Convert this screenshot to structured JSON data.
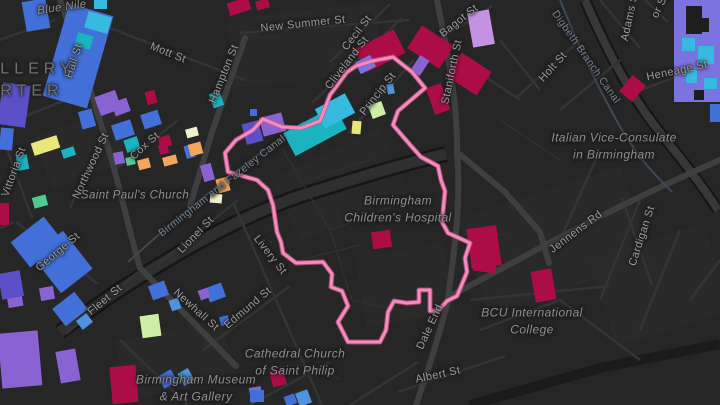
{
  "map": {
    "palette": {
      "background": "#262626",
      "road_minor": "#343434",
      "road_major": "#3f3f3f",
      "road_band_casing": "#161616",
      "road_band_fill": "#2f2f2f",
      "rail_band": "#1b1b1b",
      "canal_line": "#3d4a55",
      "label": "#9a9a9a",
      "boundary_core": "#f48cbe",
      "boundary_casing": "#c9568d",
      "buildings": {
        "crimson": "#ad0d47",
        "plum": "#c492e2",
        "purple": "#8a63d2",
        "violet": "#5b50c8",
        "blue": "#4270d8",
        "lightblue": "#4f93dc",
        "cyan": "#37b9e0",
        "teal": "#1bb3c0",
        "green": "#52c98f",
        "mint": "#cdeea6",
        "cream": "#f2f0c8",
        "yellow": "#e9e77c",
        "orange": "#f2a55c",
        "periwinkle": "#7b74e0",
        "dark": "#1e1e1e"
      }
    },
    "district_label": {
      "lines": [
        "LLERY",
        "RTER"
      ],
      "x": 2,
      "y": 80
    },
    "street_labels": [
      {
        "text": "New Summer St",
        "x": 303,
        "y": 24,
        "rot": -6
      },
      {
        "text": "Cecil St",
        "x": 357,
        "y": 33,
        "rot": -52
      },
      {
        "text": "Cliveland St",
        "x": 347,
        "y": 63,
        "rot": -52
      },
      {
        "text": "Princip St",
        "x": 378,
        "y": 94,
        "rot": -52
      },
      {
        "text": "Mott St",
        "x": 168,
        "y": 53,
        "rot": 22
      },
      {
        "text": "Hall St",
        "x": 74,
        "y": 61,
        "rot": -72
      },
      {
        "text": "Hampton St",
        "x": 224,
        "y": 74,
        "rot": -68
      },
      {
        "text": "Bagot St",
        "x": 459,
        "y": 21,
        "rot": -38
      },
      {
        "text": "Staniforth St",
        "x": 452,
        "y": 72,
        "rot": -78
      },
      {
        "text": "Holt St",
        "x": 553,
        "y": 67,
        "rot": -48
      },
      {
        "text": "Adams St",
        "x": 630,
        "y": 16,
        "rot": -78
      },
      {
        "text": "or St",
        "x": 660,
        "y": 6,
        "rot": -65
      },
      {
        "text": "Heneage St",
        "x": 677,
        "y": 71,
        "rot": -12
      },
      {
        "text": "Vittoria St",
        "x": 14,
        "y": 172,
        "rot": -70
      },
      {
        "text": "Northwood St",
        "x": 91,
        "y": 166,
        "rot": -65
      },
      {
        "text": "Cox St",
        "x": 145,
        "y": 146,
        "rot": -42
      },
      {
        "text": "George St",
        "x": 58,
        "y": 252,
        "rot": -40
      },
      {
        "text": "Lionel St",
        "x": 196,
        "y": 235,
        "rot": -46
      },
      {
        "text": "Livery St",
        "x": 270,
        "y": 255,
        "rot": 52
      },
      {
        "text": "Newhall St",
        "x": 196,
        "y": 310,
        "rot": 42
      },
      {
        "text": "Edmund St",
        "x": 248,
        "y": 308,
        "rot": -40
      },
      {
        "text": "Fleet St",
        "x": 105,
        "y": 300,
        "rot": -40
      },
      {
        "text": "Jennens Rd",
        "x": 576,
        "y": 232,
        "rot": -37
      },
      {
        "text": "Cardigan St",
        "x": 642,
        "y": 236,
        "rot": -72
      },
      {
        "text": "Dale End",
        "x": 430,
        "y": 327,
        "rot": -65
      },
      {
        "text": "Albert St",
        "x": 438,
        "y": 375,
        "rot": -12
      }
    ],
    "canal_labels": [
      {
        "text": "Digbeth Branch Canal",
        "x": 586,
        "y": 57,
        "rot": 55
      },
      {
        "text": "Birmingham and Fazeley Canal",
        "x": 222,
        "y": 186,
        "rot": -38
      }
    ],
    "poi_labels": [
      {
        "lines": [
          "Blue Nile"
        ],
        "x": 62,
        "y": 8,
        "rot": -8
      },
      {
        "lines": [
          "Saint Paul's Church"
        ],
        "x": 135,
        "y": 196,
        "rot": 0
      },
      {
        "lines": [
          "Birmingham",
          "Children's Hospital"
        ],
        "x": 398,
        "y": 210,
        "rot": 0,
        "fs": 12
      },
      {
        "lines": [
          "Italian Vice-Consulate",
          "in Birmingham"
        ],
        "x": 614,
        "y": 147,
        "rot": 0,
        "fs": 12
      },
      {
        "lines": [
          "Cathedral Church",
          "of Saint Philip"
        ],
        "x": 295,
        "y": 363,
        "rot": 0,
        "fs": 12
      },
      {
        "lines": [
          "Birmingham Museum",
          "& Art Gallery"
        ],
        "x": 196,
        "y": 389,
        "rot": 0,
        "fs": 12
      },
      {
        "lines": [
          "BCU International",
          "College"
        ],
        "x": 532,
        "y": 322,
        "rot": 0,
        "fs": 12
      }
    ],
    "boundary": {
      "points": "253,130 263,119 282,127 301,128 320,121 330,95 347,72 356,66 372,61 393,57 412,72 425,88 398,111 393,125 412,147 421,157 438,166 441,180 445,191 442,222 448,233 470,243 465,258 467,272 457,296 447,301 438,311 430,311 430,290 419,290 419,302 407,303 394,301 388,312 386,330 380,342 348,342 338,322 348,306 342,291 331,287 332,274 323,262 296,263 283,253 281,242 277,232 273,205 268,190 257,180 228,172 225,153 236,140"
    },
    "buildings": [
      [
        55,
        8,
        46,
        96,
        16,
        "blue"
      ],
      [
        86,
        14,
        24,
        17,
        16,
        "cyan"
      ],
      [
        76,
        34,
        16,
        14,
        16,
        "teal"
      ],
      [
        24,
        0,
        24,
        30,
        -10,
        "blue"
      ],
      [
        94,
        0,
        13,
        9,
        0,
        "cyan"
      ],
      [
        0,
        84,
        28,
        42,
        8,
        "violet"
      ],
      [
        0,
        128,
        13,
        22,
        5,
        "blue"
      ],
      [
        32,
        139,
        27,
        13,
        -18,
        "yellow"
      ],
      [
        62,
        148,
        13,
        9,
        -18,
        "teal"
      ],
      [
        17,
        155,
        11,
        15,
        -10,
        "teal"
      ],
      [
        33,
        196,
        14,
        11,
        -15,
        "green"
      ],
      [
        0,
        203,
        9,
        22,
        0,
        "crimson"
      ],
      [
        114,
        152,
        10,
        12,
        -12,
        "purple"
      ],
      [
        126,
        157,
        9,
        8,
        -12,
        "green"
      ],
      [
        138,
        159,
        12,
        10,
        -15,
        "orange"
      ],
      [
        159,
        144,
        9,
        10,
        -15,
        "crimson"
      ],
      [
        185,
        145,
        9,
        13,
        -15,
        "blue"
      ],
      [
        202,
        164,
        11,
        17,
        -15,
        "purple"
      ],
      [
        217,
        178,
        12,
        14,
        -15,
        "orange"
      ],
      [
        97,
        93,
        22,
        20,
        -20,
        "purple"
      ],
      [
        113,
        100,
        16,
        14,
        -20,
        "purple"
      ],
      [
        80,
        110,
        14,
        18,
        -15,
        "blue"
      ],
      [
        113,
        122,
        20,
        16,
        -18,
        "blue"
      ],
      [
        125,
        138,
        14,
        13,
        -18,
        "teal"
      ],
      [
        146,
        91,
        10,
        13,
        -15,
        "crimson"
      ],
      [
        142,
        112,
        18,
        15,
        -18,
        "blue"
      ],
      [
        159,
        136,
        12,
        11,
        -18,
        "crimson"
      ],
      [
        186,
        128,
        12,
        9,
        -15,
        "cream"
      ],
      [
        189,
        143,
        13,
        12,
        -15,
        "orange"
      ],
      [
        163,
        156,
        14,
        9,
        -15,
        "orange"
      ],
      [
        211,
        92,
        11,
        15,
        -20,
        "teal"
      ],
      [
        244,
        122,
        17,
        21,
        -15,
        "violet"
      ],
      [
        261,
        115,
        23,
        19,
        -15,
        "purple"
      ],
      [
        250,
        109,
        7,
        7,
        0,
        "blue"
      ],
      [
        210,
        194,
        12,
        9,
        5,
        "cream"
      ],
      [
        0,
        332,
        40,
        55,
        -5,
        "purple"
      ],
      [
        58,
        350,
        20,
        32,
        -10,
        "purple"
      ],
      [
        16,
        226,
        42,
        32,
        -38,
        "blue"
      ],
      [
        42,
        238,
        40,
        48,
        -38,
        "blue"
      ],
      [
        7,
        288,
        15,
        19,
        -10,
        "purple"
      ],
      [
        40,
        287,
        14,
        13,
        -10,
        "purple"
      ],
      [
        0,
        272,
        22,
        26,
        -10,
        "violet"
      ],
      [
        56,
        298,
        28,
        22,
        -38,
        "blue"
      ],
      [
        78,
        316,
        13,
        11,
        -38,
        "lightblue"
      ],
      [
        150,
        283,
        17,
        15,
        -20,
        "blue"
      ],
      [
        170,
        299,
        10,
        11,
        -20,
        "lightblue"
      ],
      [
        207,
        285,
        17,
        15,
        -20,
        "blue"
      ],
      [
        199,
        289,
        10,
        10,
        -20,
        "purple"
      ],
      [
        141,
        315,
        19,
        22,
        -8,
        "mint"
      ],
      [
        220,
        316,
        9,
        9,
        -15,
        "blue"
      ],
      [
        111,
        366,
        26,
        37,
        -5,
        "crimson"
      ],
      [
        160,
        372,
        15,
        14,
        -30,
        "blue"
      ],
      [
        180,
        370,
        12,
        14,
        -30,
        "lightblue"
      ],
      [
        250,
        387,
        12,
        15,
        -10,
        "purple"
      ],
      [
        285,
        395,
        11,
        10,
        -20,
        "blue"
      ],
      [
        297,
        391,
        13,
        14,
        -20,
        "lightblue"
      ],
      [
        271,
        370,
        14,
        16,
        -15,
        "crimson"
      ],
      [
        250,
        390,
        14,
        12,
        0,
        "blue"
      ],
      [
        372,
        231,
        19,
        17,
        -8,
        "crimson"
      ],
      [
        469,
        227,
        30,
        40,
        -8,
        "crimson"
      ],
      [
        474,
        258,
        22,
        14,
        6,
        "crimson"
      ],
      [
        533,
        270,
        21,
        31,
        -10,
        "crimson"
      ],
      [
        228,
        0,
        22,
        13,
        -18,
        "crimson"
      ],
      [
        256,
        0,
        13,
        9,
        -15,
        "crimson"
      ],
      [
        358,
        38,
        44,
        26,
        -27,
        "crimson"
      ],
      [
        357,
        58,
        17,
        13,
        -27,
        "periwinkle"
      ],
      [
        387,
        84,
        7,
        10,
        -10,
        "lightblue"
      ],
      [
        370,
        103,
        14,
        14,
        -20,
        "mint"
      ],
      [
        352,
        121,
        9,
        13,
        5,
        "yellow"
      ],
      [
        417,
        28,
        27,
        38,
        -57,
        "crimson"
      ],
      [
        455,
        56,
        28,
        36,
        -57,
        "crimson"
      ],
      [
        411,
        60,
        18,
        11,
        -57,
        "purple"
      ],
      [
        470,
        11,
        22,
        35,
        -10,
        "plum"
      ],
      [
        430,
        85,
        16,
        28,
        -20,
        "crimson"
      ],
      [
        622,
        80,
        21,
        17,
        -50,
        "crimson"
      ],
      [
        286,
        118,
        58,
        26,
        -28,
        "teal"
      ],
      [
        318,
        100,
        34,
        22,
        -28,
        "cyan"
      ],
      [
        674,
        0,
        46,
        102,
        0,
        "periwinkle"
      ],
      [
        686,
        6,
        16,
        28,
        0,
        "dark"
      ],
      [
        700,
        18,
        9,
        14,
        0,
        "dark"
      ],
      [
        682,
        38,
        13,
        13,
        0,
        "cyan"
      ],
      [
        698,
        46,
        16,
        18,
        0,
        "cyan"
      ],
      [
        686,
        70,
        11,
        13,
        0,
        "cyan"
      ],
      [
        704,
        78,
        13,
        11,
        0,
        "cyan"
      ],
      [
        694,
        90,
        10,
        10,
        0,
        "dark"
      ],
      [
        710,
        104,
        10,
        18,
        0,
        "blue"
      ]
    ]
  }
}
